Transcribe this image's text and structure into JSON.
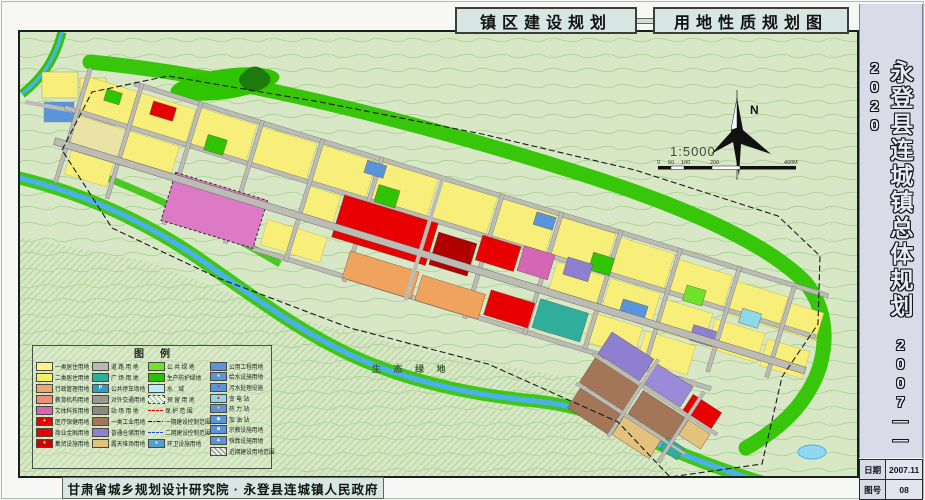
{
  "doc": {
    "tabs": {
      "left": "镇区建设规划",
      "right": "用地性质规划图"
    },
    "sidebar": {
      "title": "永登县连城镇总体规划",
      "period": "2007——2020",
      "table": {
        "date_label": "日期",
        "date_value": "2007.11",
        "sheet_label": "图号",
        "sheet_value": "08"
      }
    },
    "footer": {
      "credit": "甘肃省城乡规划设计研究院 · 永登县连城镇人民政府"
    }
  },
  "map": {
    "north": "N",
    "scale_text": "1:5000",
    "scalebar": [
      "0",
      "50",
      "100",
      "200",
      "400M"
    ],
    "eco_label": "生 态 绿 地"
  },
  "legend": {
    "title": "图例",
    "columns": [
      [
        {
          "label": "一类居住用地",
          "sw": {
            "t": "s",
            "c": "#fbf38a"
          }
        },
        {
          "label": "二类居住用地",
          "sw": {
            "t": "s",
            "c": "#f7ee67"
          }
        },
        {
          "label": "行政管理用地",
          "sw": {
            "t": "s",
            "c": "#f2a470"
          }
        },
        {
          "label": "教育机构用地",
          "sw": {
            "t": "s",
            "c": "#ef8d78"
          }
        },
        {
          "label": "文体科技用地",
          "sw": {
            "t": "s",
            "c": "#d565b5"
          }
        },
        {
          "label": "医疗保健用地",
          "sw": {
            "t": "s",
            "c": "#e60000",
            "icon": "+",
            "ic": "#ffffff"
          }
        },
        {
          "label": "商业金融用地",
          "sw": {
            "t": "s",
            "c": "#e60000"
          }
        },
        {
          "label": "集贸设施用地",
          "sw": {
            "t": "s",
            "c": "#cf0000",
            "icon": "★",
            "ic": "#ffe24a"
          }
        }
      ],
      [
        {
          "label": "道 路 用 地",
          "sw": {
            "t": "s",
            "c": "#bab9b1"
          }
        },
        {
          "label": "广 场 用 地",
          "sw": {
            "t": "s",
            "c": "#2fae9e"
          }
        },
        {
          "label": "公共停车场地",
          "sw": {
            "t": "s",
            "c": "#2f9ec0",
            "icon": "P",
            "ic": "#ffffff"
          }
        },
        {
          "label": "对外交通用地",
          "sw": {
            "t": "s",
            "c": "#9b9a92"
          }
        },
        {
          "label": "站 场 用 地",
          "sw": {
            "t": "s",
            "c": "#8a8a80"
          }
        },
        {
          "label": "一类工业用地",
          "sw": {
            "t": "s",
            "c": "#a3765a"
          }
        },
        {
          "label": "普通仓储用地",
          "sw": {
            "t": "s",
            "c": "#8f7fd0"
          }
        },
        {
          "label": "露天堆场用地",
          "sw": {
            "t": "s",
            "c": "#e3c27e"
          }
        }
      ],
      [
        {
          "label": "公 共 绿 地",
          "sw": {
            "t": "s",
            "c": "#6fe32a"
          }
        },
        {
          "label": "生产防护绿地",
          "sw": {
            "t": "s",
            "c": "#2bbf00"
          }
        },
        {
          "label": "水　域",
          "sw": {
            "t": "s",
            "c": "#b5eef8"
          }
        },
        {
          "label": "预 留 用 地",
          "sw": {
            "t": "h",
            "c": "#9fd48f"
          }
        },
        {
          "label": "保 护 范 围",
          "sw": {
            "t": "l",
            "ls": "reddash"
          }
        },
        {
          "label": "一期建设控制范围",
          "sw": {
            "t": "l",
            "ls": "dashdot"
          }
        },
        {
          "label": "二期建设控制范围",
          "sw": {
            "t": "l",
            "ls": "bluedash"
          }
        },
        {
          "label": "环卫设施用地",
          "sw": {
            "t": "s",
            "c": "#55a0c8",
            "icon": "●",
            "ic": "#eef2ff"
          }
        }
      ],
      [
        {
          "label": "公用工程用地",
          "sw": {
            "t": "s",
            "c": "#5a95dc"
          }
        },
        {
          "label": "给水设施用地",
          "sw": {
            "t": "s",
            "c": "#5a95dc",
            "icon": "●",
            "ic": "#ffffff"
          }
        },
        {
          "label": "污水处理设施",
          "sw": {
            "t": "s",
            "c": "#5a95dc",
            "icon": "●",
            "ic": "#e23333"
          }
        },
        {
          "label": "变 电 站",
          "sw": {
            "t": "s",
            "c": "#8fd8e8",
            "icon": "▲",
            "ic": "#e23333"
          }
        },
        {
          "label": "热 力 站",
          "sw": {
            "t": "s",
            "c": "#5a95dc",
            "icon": "●",
            "ic": "#ffd24a"
          }
        },
        {
          "label": "加 油 站",
          "sw": {
            "t": "s",
            "c": "#5a95dc",
            "icon": "◆",
            "ic": "#ffffff"
          }
        },
        {
          "label": "宗教设施用地",
          "sw": {
            "t": "s",
            "c": "#5a95dc",
            "icon": "■",
            "ic": "#fffbe8"
          }
        },
        {
          "label": "殡葬设施用地",
          "sw": {
            "t": "s",
            "c": "#5a95dc",
            "icon": "▲",
            "ic": "#ffffff"
          }
        },
        {
          "label": "近期建设用地范围",
          "sw": {
            "t": "h2",
            "c": "#9a9a9a"
          }
        }
      ]
    ]
  },
  "colors": {
    "tab_bg": "#d7e6e2",
    "sidebar_bg": "#d9dbe9",
    "map_base": "#d8e8c6",
    "contour": "#a8d193",
    "river": "#4db0e8",
    "green_belt": "#2fc400",
    "residential_yellow": "#f7ef7a",
    "commercial_red": "#e80000",
    "industry_brown": "#a3765a",
    "warehouse_purple": "#8f7fd0",
    "road_gray": "#bcbcb4",
    "pink_block": "#dc7ac6"
  }
}
